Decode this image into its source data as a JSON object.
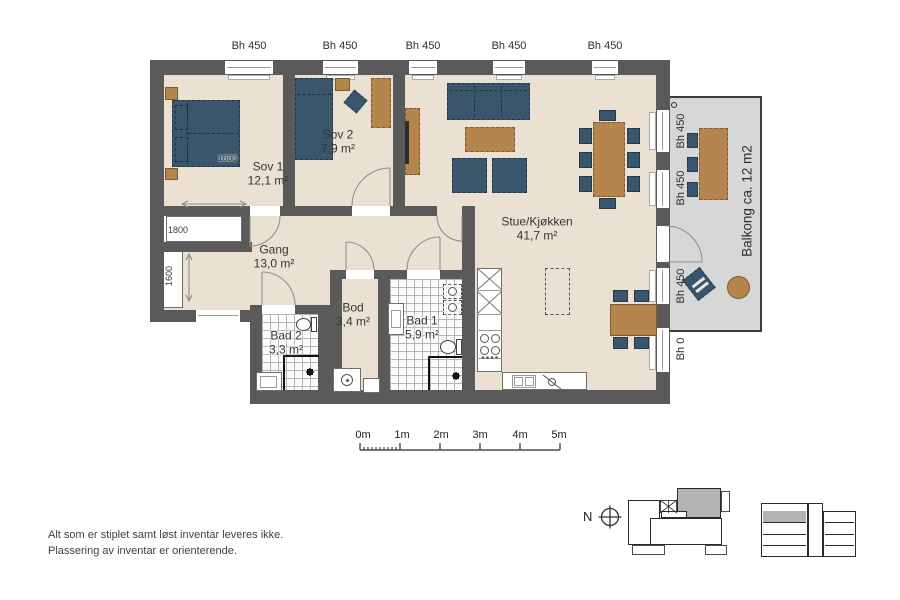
{
  "floorplan": {
    "rooms": [
      {
        "name": "Sov 1",
        "area": "12,1 m²"
      },
      {
        "name": "Sov 2",
        "area": "7,9 m²"
      },
      {
        "name": "Gang",
        "area": "13,0 m²"
      },
      {
        "name": "Bod",
        "area": "3,4 m²"
      },
      {
        "name": "Bad 2",
        "area": "3,3 m²"
      },
      {
        "name": "Bad 1",
        "area": "5,9 m²"
      },
      {
        "name": "Stue/Kjøkken",
        "area": "41,7 m²"
      }
    ],
    "balcony_label": "Balkong ca. 12 m2",
    "top_window_labels": [
      "Bh 450",
      "Bh 450",
      "Bh 450",
      "Bh 450",
      "Bh 450"
    ],
    "right_window_labels": [
      "Bh 450",
      "Bh 450",
      "Bh 450"
    ],
    "below_balcony_label": "Bh 0",
    "dimensions": {
      "bed_width": "1600",
      "wardrobe_top": "1800",
      "wardrobe_left": "1600"
    }
  },
  "scale_bar": {
    "labels": [
      "0m",
      "1m",
      "2m",
      "3m",
      "4m",
      "5m"
    ]
  },
  "compass_label": "N",
  "notes": {
    "line1": "Alt som er stiplet samt løst inventar leveres ikke.",
    "line2": "Plassering av inventar er orienterende."
  },
  "colors": {
    "wall": "#5a5a5a",
    "floor": "#eae1d3",
    "balcony_floor": "#d7d7d7",
    "furniture_blue": "#3a566d",
    "furniture_brown": "#b5854e",
    "highlight_gray": "#b3b3b3"
  }
}
